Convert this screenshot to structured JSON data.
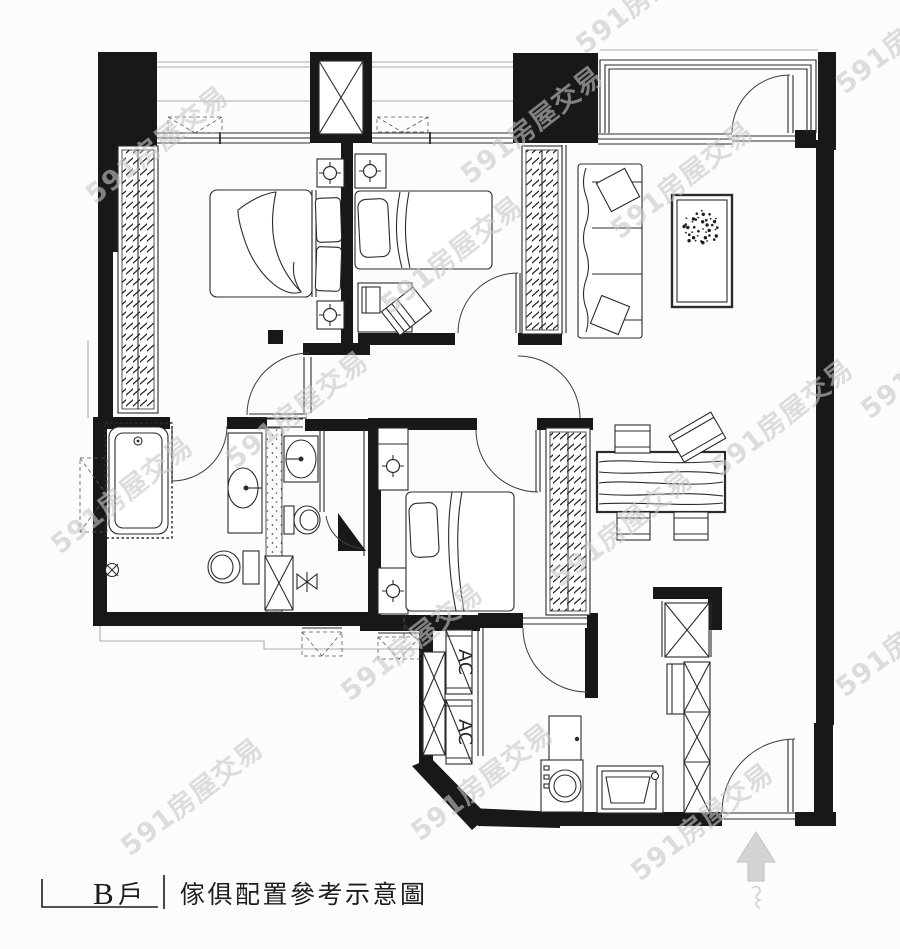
{
  "caption": {
    "unit_letter": "B",
    "unit_suffix": "戶",
    "title": "傢俱配置參考示意圖"
  },
  "labels": {
    "ac": "AC"
  },
  "watermark": {
    "text": "591房屋交易"
  },
  "colors": {
    "wall": "#181818",
    "line": "#2b2b2b",
    "watermark": "#c8c8c8",
    "background": "#fcfcfa",
    "north_arrow": "#d4d4d4"
  }
}
